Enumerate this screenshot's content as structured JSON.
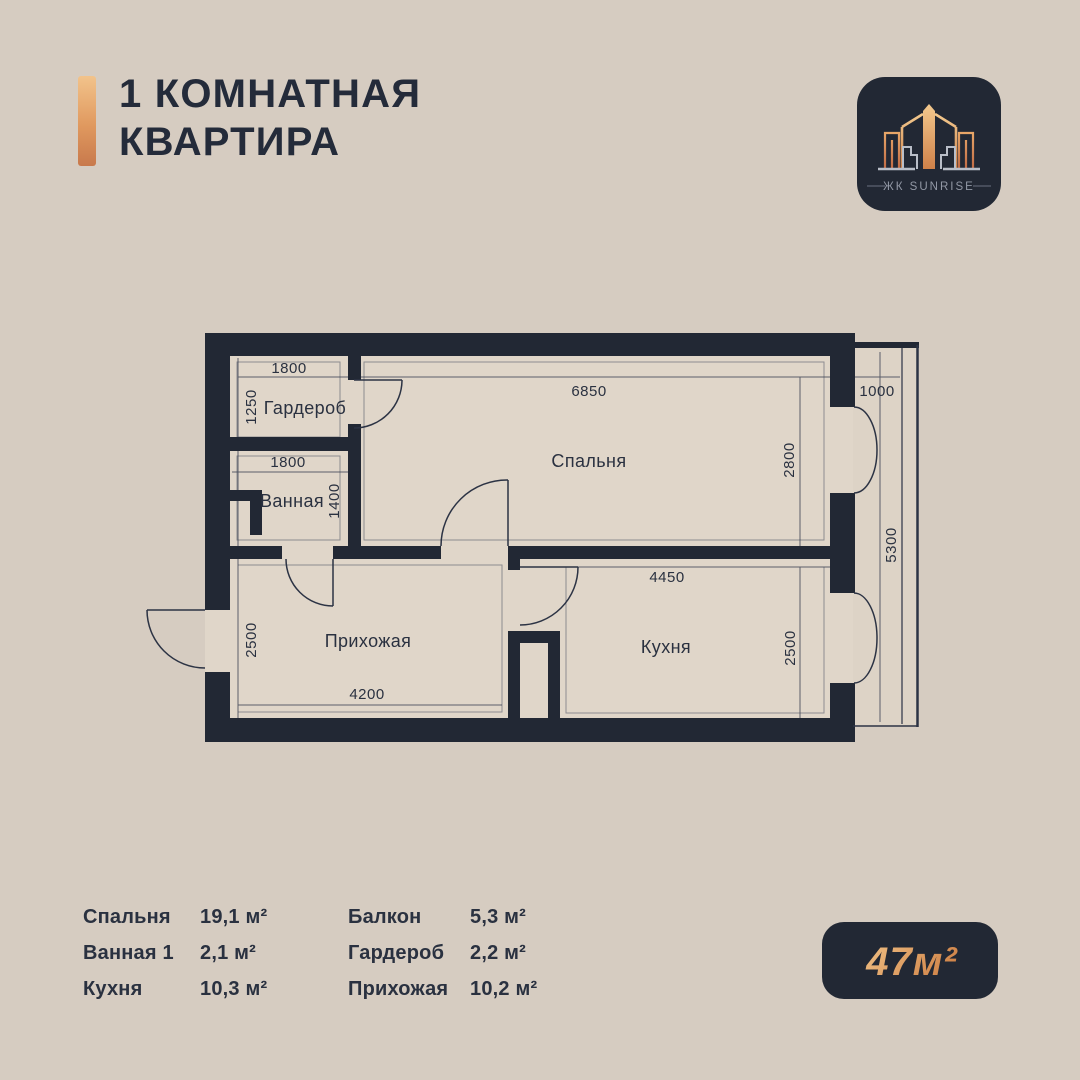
{
  "title": {
    "line1": "1 КОМНАТНАЯ",
    "line2": "КВАРТИРА"
  },
  "logo": {
    "brand": "ЖК SUNRISE"
  },
  "plan": {
    "rooms": {
      "wardrobe": "Гардероб",
      "bathroom": "Ванная",
      "bedroom": "Спальня",
      "hallway": "Прихожая",
      "kitchen": "Кухня"
    },
    "dims": {
      "wardrobe_w": "1800",
      "wardrobe_d": "1250",
      "bedroom_w": "6850",
      "bedroom_d": "2800",
      "balcony_w": "1000",
      "balcony_l": "5300",
      "bathroom_w": "1800",
      "bathroom_d": "1400",
      "kitchen_w": "4450",
      "kitchen_d": "2500",
      "hallway_w": "4200",
      "hallway_d": "2500"
    }
  },
  "legend": {
    "columns": [
      {
        "rows": [
          {
            "label": "Спальня",
            "value": "19,1 м²"
          },
          {
            "label": "Ванная 1",
            "value": "2,1 м²"
          },
          {
            "label": "Кухня",
            "value": "10,3 м²"
          }
        ]
      },
      {
        "rows": [
          {
            "label": "Балкон",
            "value": "5,3 м²"
          },
          {
            "label": "Гардероб",
            "value": "2,2 м²"
          },
          {
            "label": "Прихожая",
            "value": "10,2 м²"
          }
        ]
      }
    ]
  },
  "badge": {
    "total_area": "47м²"
  },
  "colors": {
    "background": "#d6ccc1",
    "floor": "#e0d6c9",
    "wall": "#222834",
    "text": "#2a3140",
    "accent_light": "#f2c38b",
    "accent_dark": "#c8794c",
    "logo_text": "#9298a5"
  }
}
